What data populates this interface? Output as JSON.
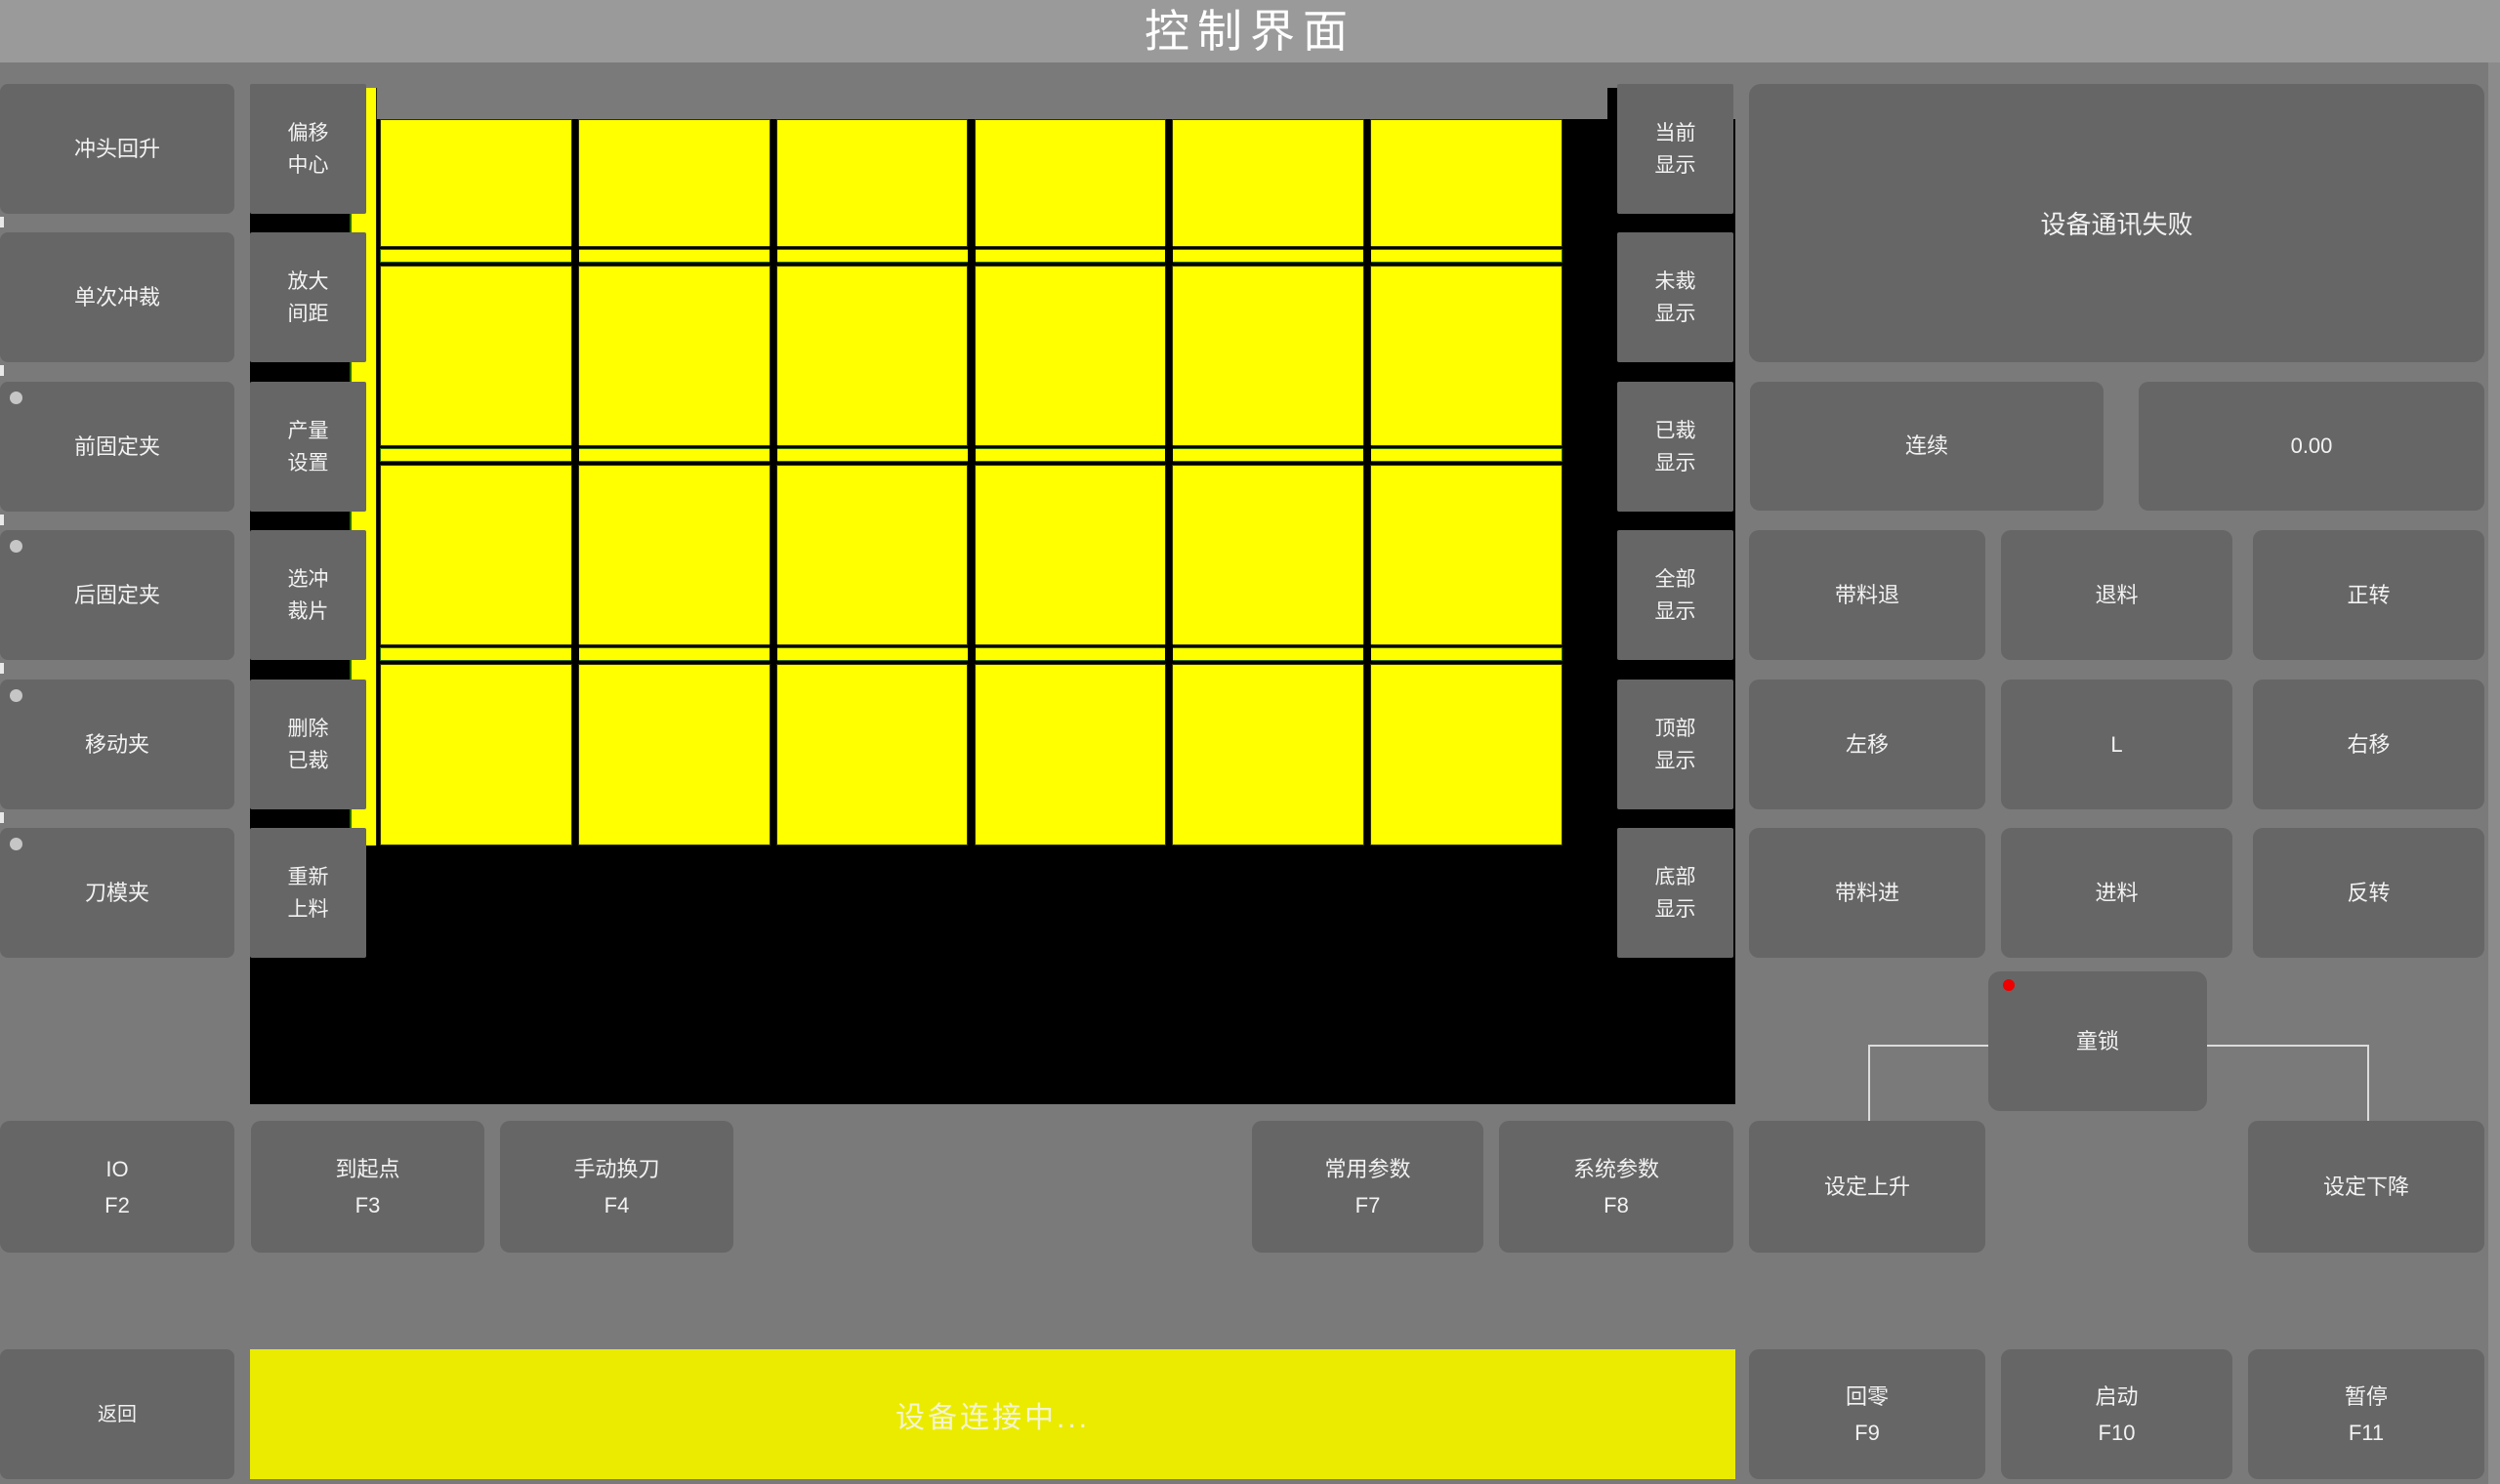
{
  "title": "控制界面",
  "left_panel": {
    "buttons": [
      {
        "label": "冲头回升",
        "indicator": false
      },
      {
        "label": "单次冲裁",
        "indicator": false
      },
      {
        "label": "前固定夹",
        "indicator": true
      },
      {
        "label": "后固定夹",
        "indicator": true
      },
      {
        "label": "移动夹",
        "indicator": true
      },
      {
        "label": "刀模夹",
        "indicator": true
      }
    ]
  },
  "tool_panel": {
    "buttons": [
      [
        "偏移",
        "中心"
      ],
      [
        "放大",
        "间距"
      ],
      [
        "产量",
        "设置"
      ],
      [
        "选冲",
        "裁片"
      ],
      [
        "删除",
        "已裁"
      ],
      [
        "重新",
        "上料"
      ]
    ]
  },
  "display_panel": {
    "buttons": [
      [
        "当前",
        "显示"
      ],
      [
        "未裁",
        "显示"
      ],
      [
        "已裁",
        "显示"
      ],
      [
        "全部",
        "显示"
      ],
      [
        "顶部",
        "显示"
      ],
      [
        "底部",
        "显示"
      ]
    ]
  },
  "canvas": {
    "columns": 6,
    "rows": 4,
    "sheet_color": "#ffff00",
    "background_color": "#000000"
  },
  "right_panel": {
    "message": "设备通讯失败",
    "continuous_label": "连续",
    "value": "0.00",
    "jog_buttons": [
      "带料退",
      "退料",
      "正转",
      "左移",
      "L",
      "右移",
      "带料进",
      "进料",
      "反转"
    ],
    "child_lock_label": "童锁",
    "child_lock_indicator_color": "#ee0000"
  },
  "function_row": {
    "buttons": [
      {
        "label": "IO",
        "key": "F2"
      },
      {
        "label": "到起点",
        "key": "F3"
      },
      {
        "label": "手动换刀",
        "key": "F4"
      },
      {
        "label": "常用参数",
        "key": "F7"
      },
      {
        "label": "系统参数",
        "key": "F8"
      },
      {
        "label": "设定上升",
        "key": ""
      },
      {
        "label": "设定下降",
        "key": ""
      }
    ]
  },
  "bottom_bar": {
    "back_label": "返回",
    "status_text": "设备连接中...",
    "status_bar_color": "#ebeb00",
    "status_text_color": "#f4f4cf",
    "buttons": [
      {
        "label": "回零",
        "key": "F9"
      },
      {
        "label": "启动",
        "key": "F10"
      },
      {
        "label": "暂停",
        "key": "F11"
      }
    ]
  }
}
